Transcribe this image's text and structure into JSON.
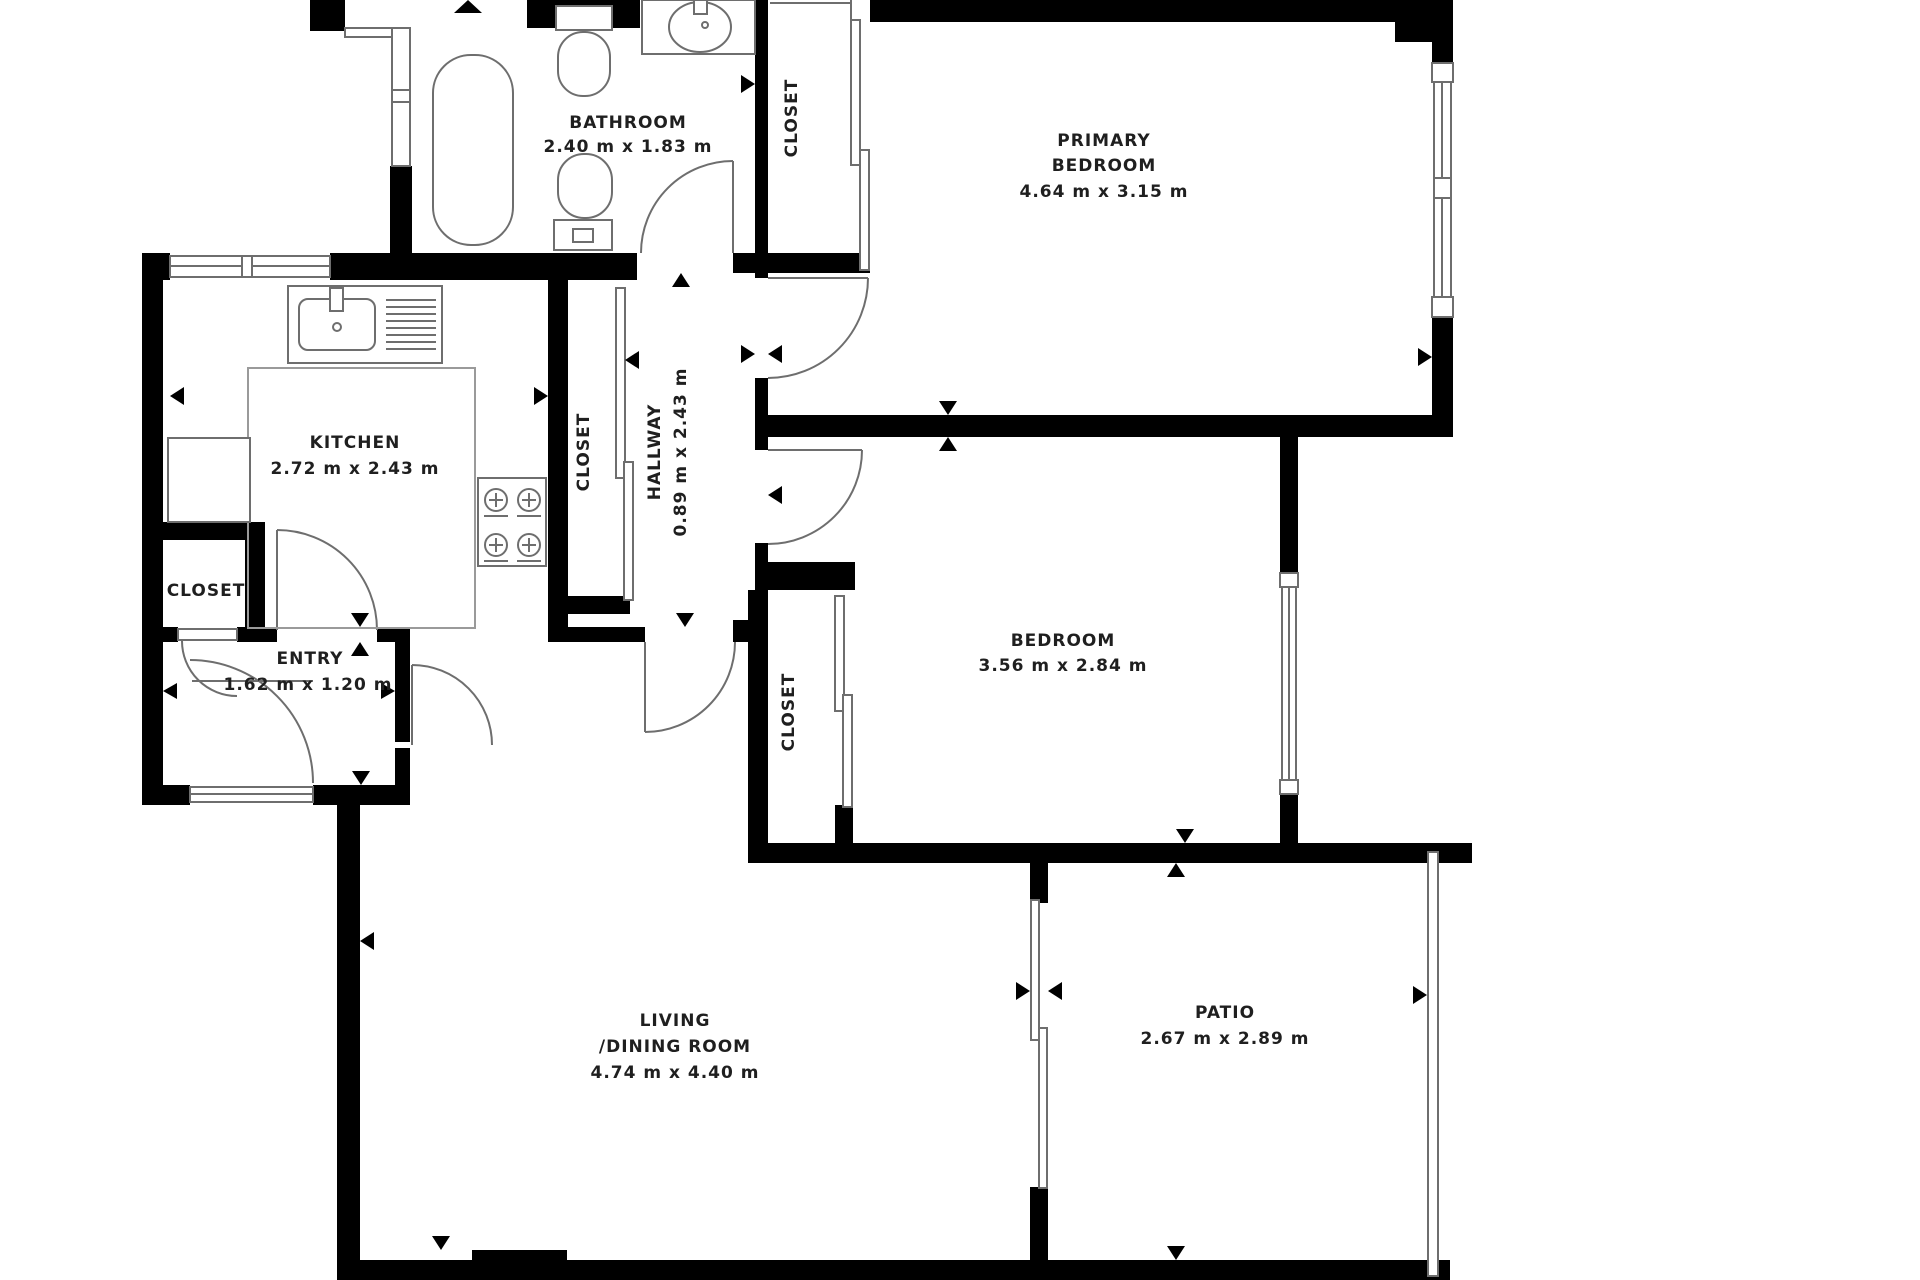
{
  "rooms": {
    "bathroom": {
      "name": "BATHROOM",
      "dims": "2.40 m x 1.83 m"
    },
    "closet_top": {
      "name": "CLOSET"
    },
    "primary_bedroom": {
      "line1": "PRIMARY",
      "line2": "BEDROOM",
      "dims": "4.64 m x 3.15 m"
    },
    "kitchen": {
      "name": "KITCHEN",
      "dims": "2.72 m x 2.43 m"
    },
    "closet_hall": {
      "name": "CLOSET"
    },
    "hallway": {
      "name": "HALLWAY",
      "dims": "0.89 m x 2.43 m"
    },
    "closet_entry": {
      "name": "CLOSET"
    },
    "entry": {
      "name": "ENTRY",
      "dims": "1.62 m x 1.20 m"
    },
    "bedroom": {
      "name": "BEDROOM",
      "dims": "3.56 m x 2.84 m"
    },
    "closet_bedroom": {
      "name": "CLOSET"
    },
    "living": {
      "line1": "LIVING",
      "line2": "/DINING ROOM",
      "dims": "4.74 m x 4.40 m"
    },
    "patio": {
      "name": "PATIO",
      "dims": "2.67 m x 2.89 m"
    }
  },
  "colors": {
    "wall": "#000000",
    "fixture_line": "#6e6e6e",
    "floor_line": "#9a9a9a",
    "text": "#1f1f1f",
    "background": "#ffffff"
  }
}
